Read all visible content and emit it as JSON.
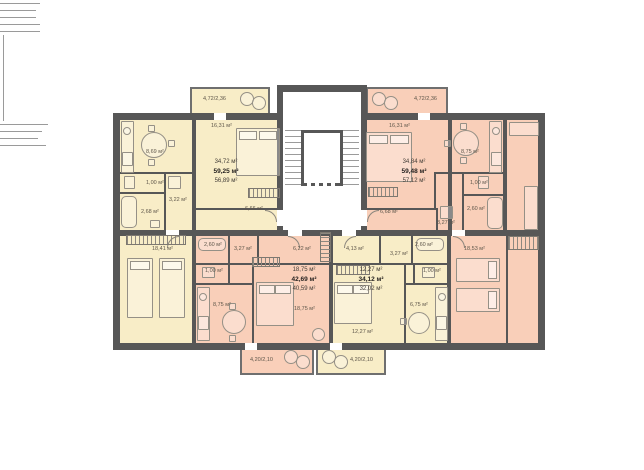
{
  "plan": {
    "type": "residential-floor-plan",
    "colors": {
      "wall": "#575757",
      "apartment_yellow": "#f8edc7",
      "apartment_pink": "#f9cfb9",
      "furniture_line": "#959086",
      "label_text": "#5f574b"
    },
    "apartments": [
      {
        "id": "top-left",
        "scheme": "yellow",
        "summary": {
          "living": "34,72 м²",
          "total": "59,25 м²",
          "area": "56,89 м²"
        },
        "rooms": {
          "kitchen": "8,69 м²",
          "bedroom": "16,31 м²",
          "wc": "1,00 м²",
          "hall": "3,22 м²",
          "bath": "2,68 м²",
          "corridor": "6,66 м²",
          "bedroom2": "18,41 м²"
        },
        "balcony": "4,72/2,36"
      },
      {
        "id": "top-right",
        "scheme": "pink",
        "summary": {
          "living": "34,84 м²",
          "total": "59,48 м²",
          "area": "57,12 м²"
        },
        "rooms": {
          "bedroom": "16,31 м²",
          "kitchen": "8,75 м²",
          "wc": "1,00 м²",
          "bath": "2,60 м²",
          "hall": "3,27 м²",
          "corridor": "6,68 м²",
          "bedroom2": "18,53 м²"
        },
        "balcony": "4,72/2,36"
      },
      {
        "id": "bottom-left",
        "scheme": "pink",
        "summary": {
          "living": "18,75 м²",
          "total": "42,69 м²",
          "area": "40,59 м²"
        },
        "rooms": {
          "bath": "2,60 м²",
          "closet": "3,27 м²",
          "hall": "6,22 м²",
          "wc": "1,00 м²",
          "kitchen": "8,75 м²",
          "living": "18,75 м²"
        },
        "balcony": "4,20/2,10"
      },
      {
        "id": "bottom-right",
        "scheme": "yellow",
        "summary": {
          "living": "12,27 м²",
          "total": "34,12 м²",
          "area": "32,02 м²"
        },
        "rooms": {
          "hall": "4,13 м²",
          "closet": "3,27 м²",
          "bath": "2,60 м²",
          "wc": "1,00 м²",
          "kitchen": "6,75 м²",
          "living": "12,27 м²"
        },
        "balcony": "4,20/2,10"
      }
    ]
  }
}
